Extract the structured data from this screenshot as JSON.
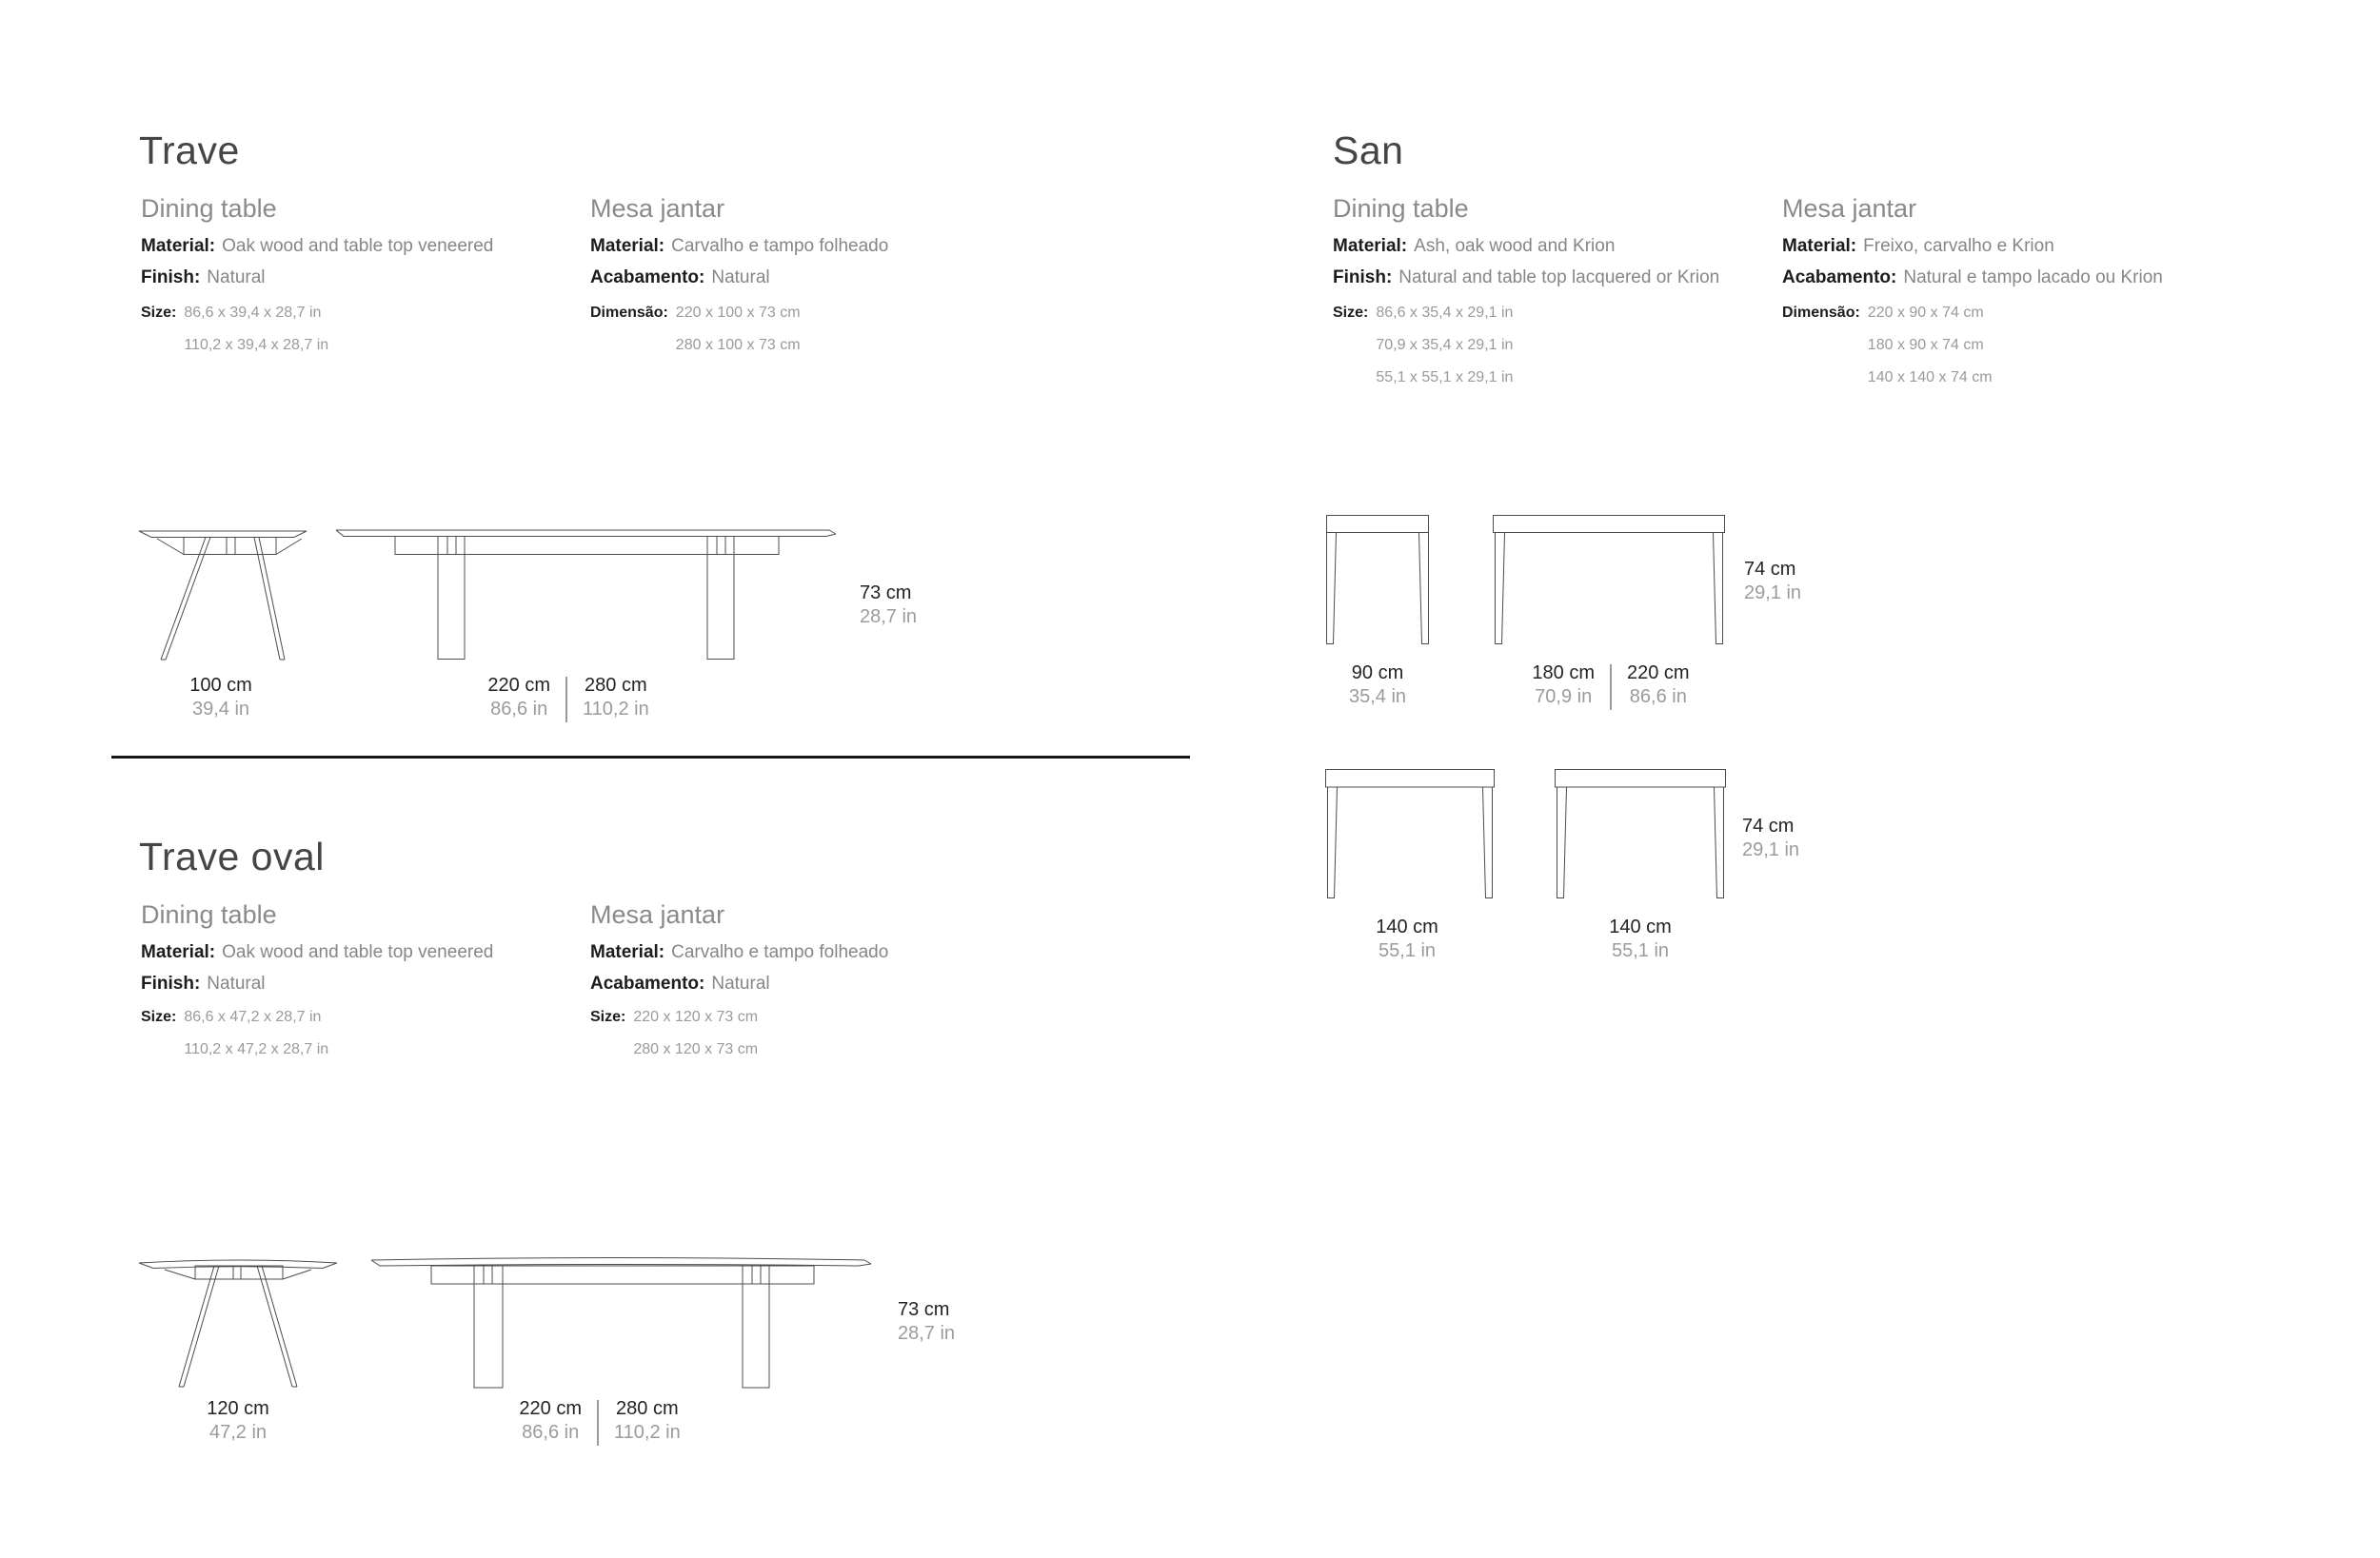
{
  "palette": {
    "background": "#ffffff",
    "text_dark": "#1c1c1c",
    "text_gray": "#868686",
    "text_light_gray": "#9b9b9b",
    "drawing_line": "#4c4c4c"
  },
  "trave": {
    "title": "Trave",
    "en": {
      "subtitle": "Dining table",
      "material_label": "Material:",
      "material_value": "Oak wood and table top veneered",
      "finish_label": "Finish:",
      "finish_value": "Natural",
      "size_label": "Size:",
      "size_values": [
        "86,6 x 39,4 x 28,7 in",
        "110,2 x 39,4 x 28,7 in"
      ]
    },
    "pt": {
      "subtitle": "Mesa jantar",
      "material_label": "Material:",
      "material_value": "Carvalho e tampo folheado",
      "finish_label": "Acabamento:",
      "finish_value": "Natural",
      "size_label": "Dimensão:",
      "size_values": [
        "220 x 100 x 73 cm",
        "280 x 100 x 73 cm"
      ]
    },
    "dims": {
      "width_cm": "100 cm",
      "width_in": "39,4 in",
      "len_a_cm": "220 cm",
      "len_a_in": "86,6 in",
      "len_b_cm": "280 cm",
      "len_b_in": "110,2 in",
      "height_cm": "73 cm",
      "height_in": "28,7 in"
    }
  },
  "trave_oval": {
    "title": "Trave oval",
    "en": {
      "subtitle": "Dining table",
      "material_label": "Material:",
      "material_value": "Oak wood and table top veneered",
      "finish_label": "Finish:",
      "finish_value": "Natural",
      "size_label": "Size:",
      "size_values": [
        "86,6 x 47,2 x 28,7 in",
        "110,2 x 47,2 x 28,7 in"
      ]
    },
    "pt": {
      "subtitle": "Mesa jantar",
      "material_label": "Material:",
      "material_value": "Carvalho e tampo folheado",
      "finish_label": "Acabamento:",
      "finish_value": "Natural",
      "size_label": "Size:",
      "size_values": [
        "220 x 120 x 73 cm",
        "280 x 120 x 73 cm"
      ]
    },
    "dims": {
      "width_cm": "120 cm",
      "width_in": "47,2 in",
      "len_a_cm": "220 cm",
      "len_a_in": "86,6 in",
      "len_b_cm": "280 cm",
      "len_b_in": "110,2 in",
      "height_cm": "73 cm",
      "height_in": "28,7 in"
    }
  },
  "san": {
    "title": "San",
    "en": {
      "subtitle": "Dining table",
      "material_label": "Material:",
      "material_value": "Ash, oak wood and Krion",
      "finish_label": "Finish:",
      "finish_value": "Natural and table top lacquered or Krion",
      "size_label": "Size:",
      "size_values": [
        "86,6 x 35,4 x 29,1 in",
        "70,9 x 35,4 x 29,1 in",
        "55,1 x 55,1 x 29,1 in"
      ]
    },
    "pt": {
      "subtitle": "Mesa jantar",
      "material_label": "Material:",
      "material_value": "Freixo, carvalho e Krion",
      "finish_label": "Acabamento:",
      "finish_value": "Natural e tampo lacado ou Krion",
      "size_label": "Dimensão:",
      "size_values": [
        "220 x 90 x 74 cm",
        "180 x 90 x 74 cm",
        "140 x 140 x 74 cm"
      ]
    },
    "dims": {
      "width_cm": "90 cm",
      "width_in": "35,4 in",
      "len_a_cm": "180 cm",
      "len_a_in": "70,9 in",
      "len_b_cm": "220 cm",
      "len_b_in": "86,6 in",
      "height_cm": "74 cm",
      "height_in": "29,1 in",
      "sq_a_cm": "140 cm",
      "sq_a_in": "55,1 in",
      "sq_b_cm": "140 cm",
      "sq_b_in": "55,1 in",
      "height2_cm": "74 cm",
      "height2_in": "29,1 in"
    }
  }
}
